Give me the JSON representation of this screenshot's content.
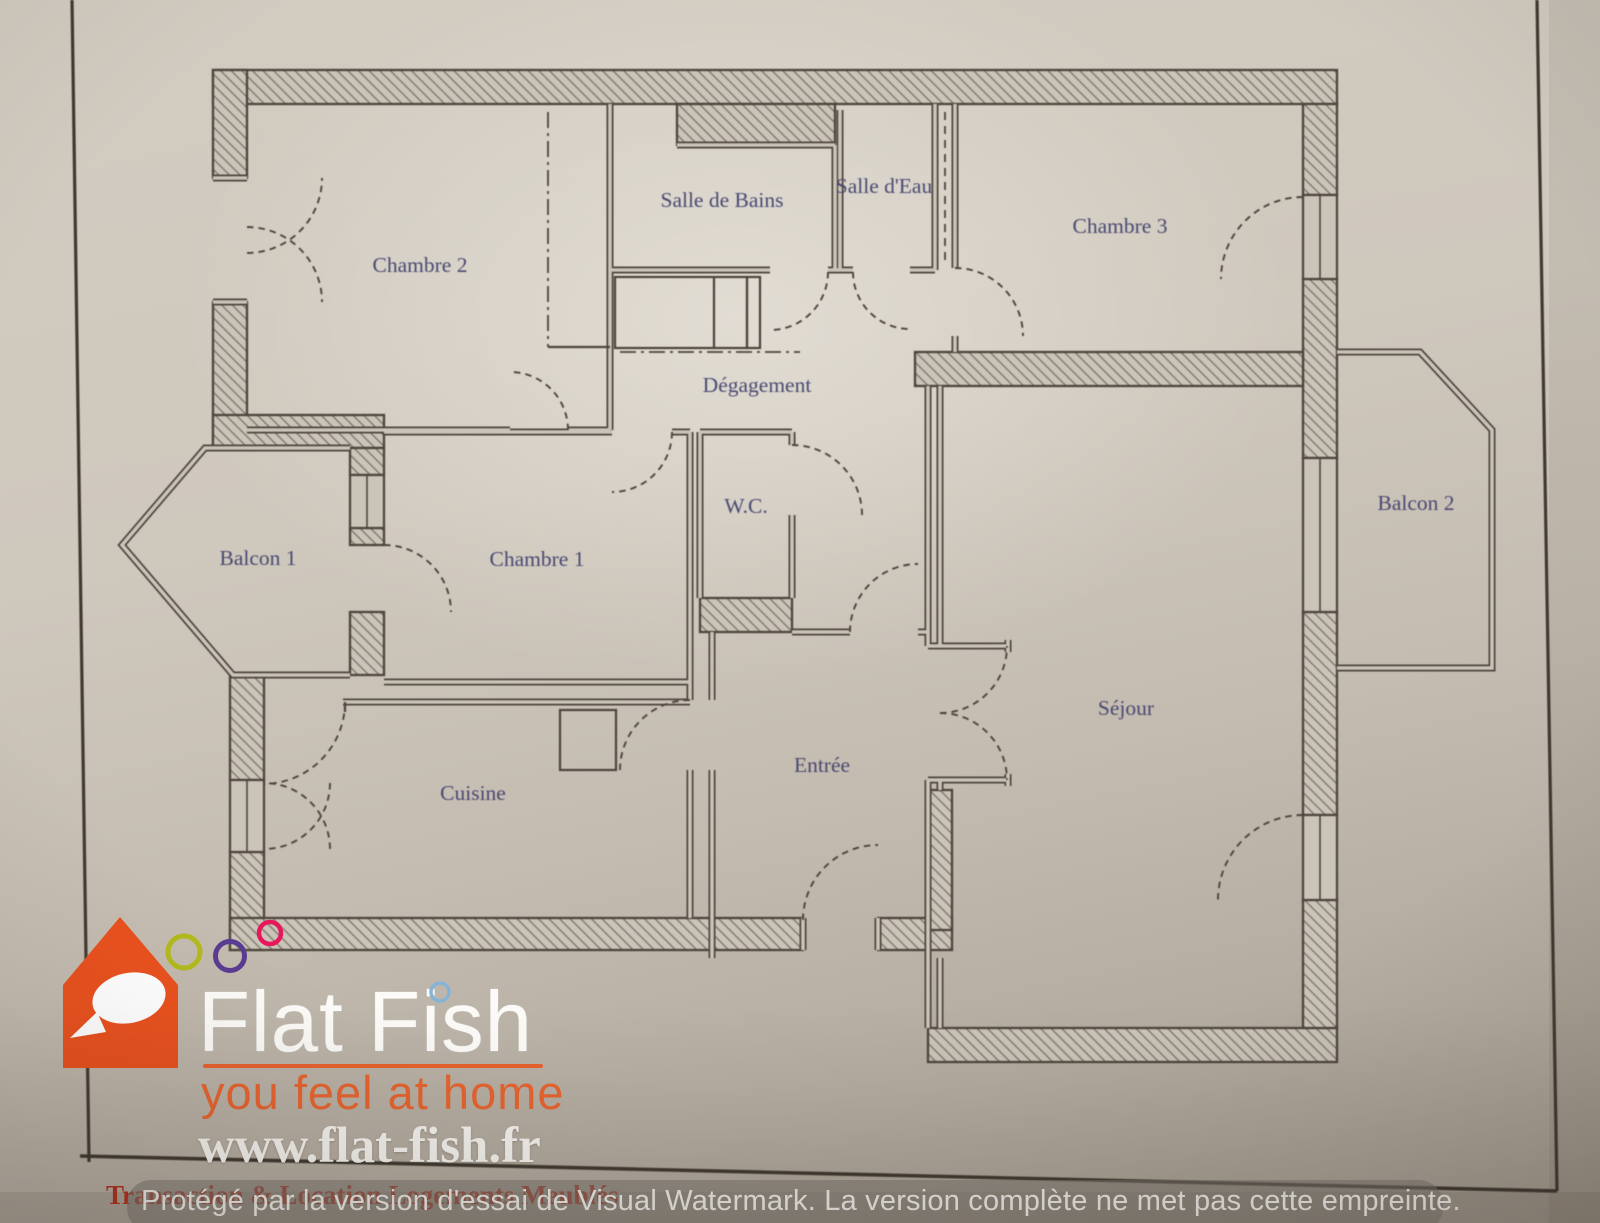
{
  "plan": {
    "rooms": [
      {
        "label": "Chambre 2"
      },
      {
        "label": "Salle de Bains"
      },
      {
        "label": "Salle d'Eau"
      },
      {
        "label": "Chambre 3"
      },
      {
        "label": "Dégagement"
      },
      {
        "label": "W.C."
      },
      {
        "label": "Chambre 1"
      },
      {
        "label": "Balcon 1"
      },
      {
        "label": "Balcon 2"
      },
      {
        "label": "Cuisine"
      },
      {
        "label": "Entrée"
      },
      {
        "label": "Séjour"
      }
    ],
    "label_color": "#41416e",
    "line_color": "#4b4339",
    "paper_color": "#cdc6ba"
  },
  "logo": {
    "title": "Flat Fish",
    "tagline": "you feel at home",
    "website": "www.flat-fish.fr",
    "subtitle": "Transaction & Location Logements Meublés",
    "colors": {
      "house": "#e9511e",
      "accent": "#e8622d",
      "ring_olive": "#b2ba1d",
      "ring_purple": "#5a3b92",
      "ring_pink": "#e7175c",
      "ring_blue": "#85b4d6"
    }
  },
  "watermark": {
    "text": "Protégé par la version d'essai de Visual Watermark. La version complète ne met pas cette empreinte."
  }
}
